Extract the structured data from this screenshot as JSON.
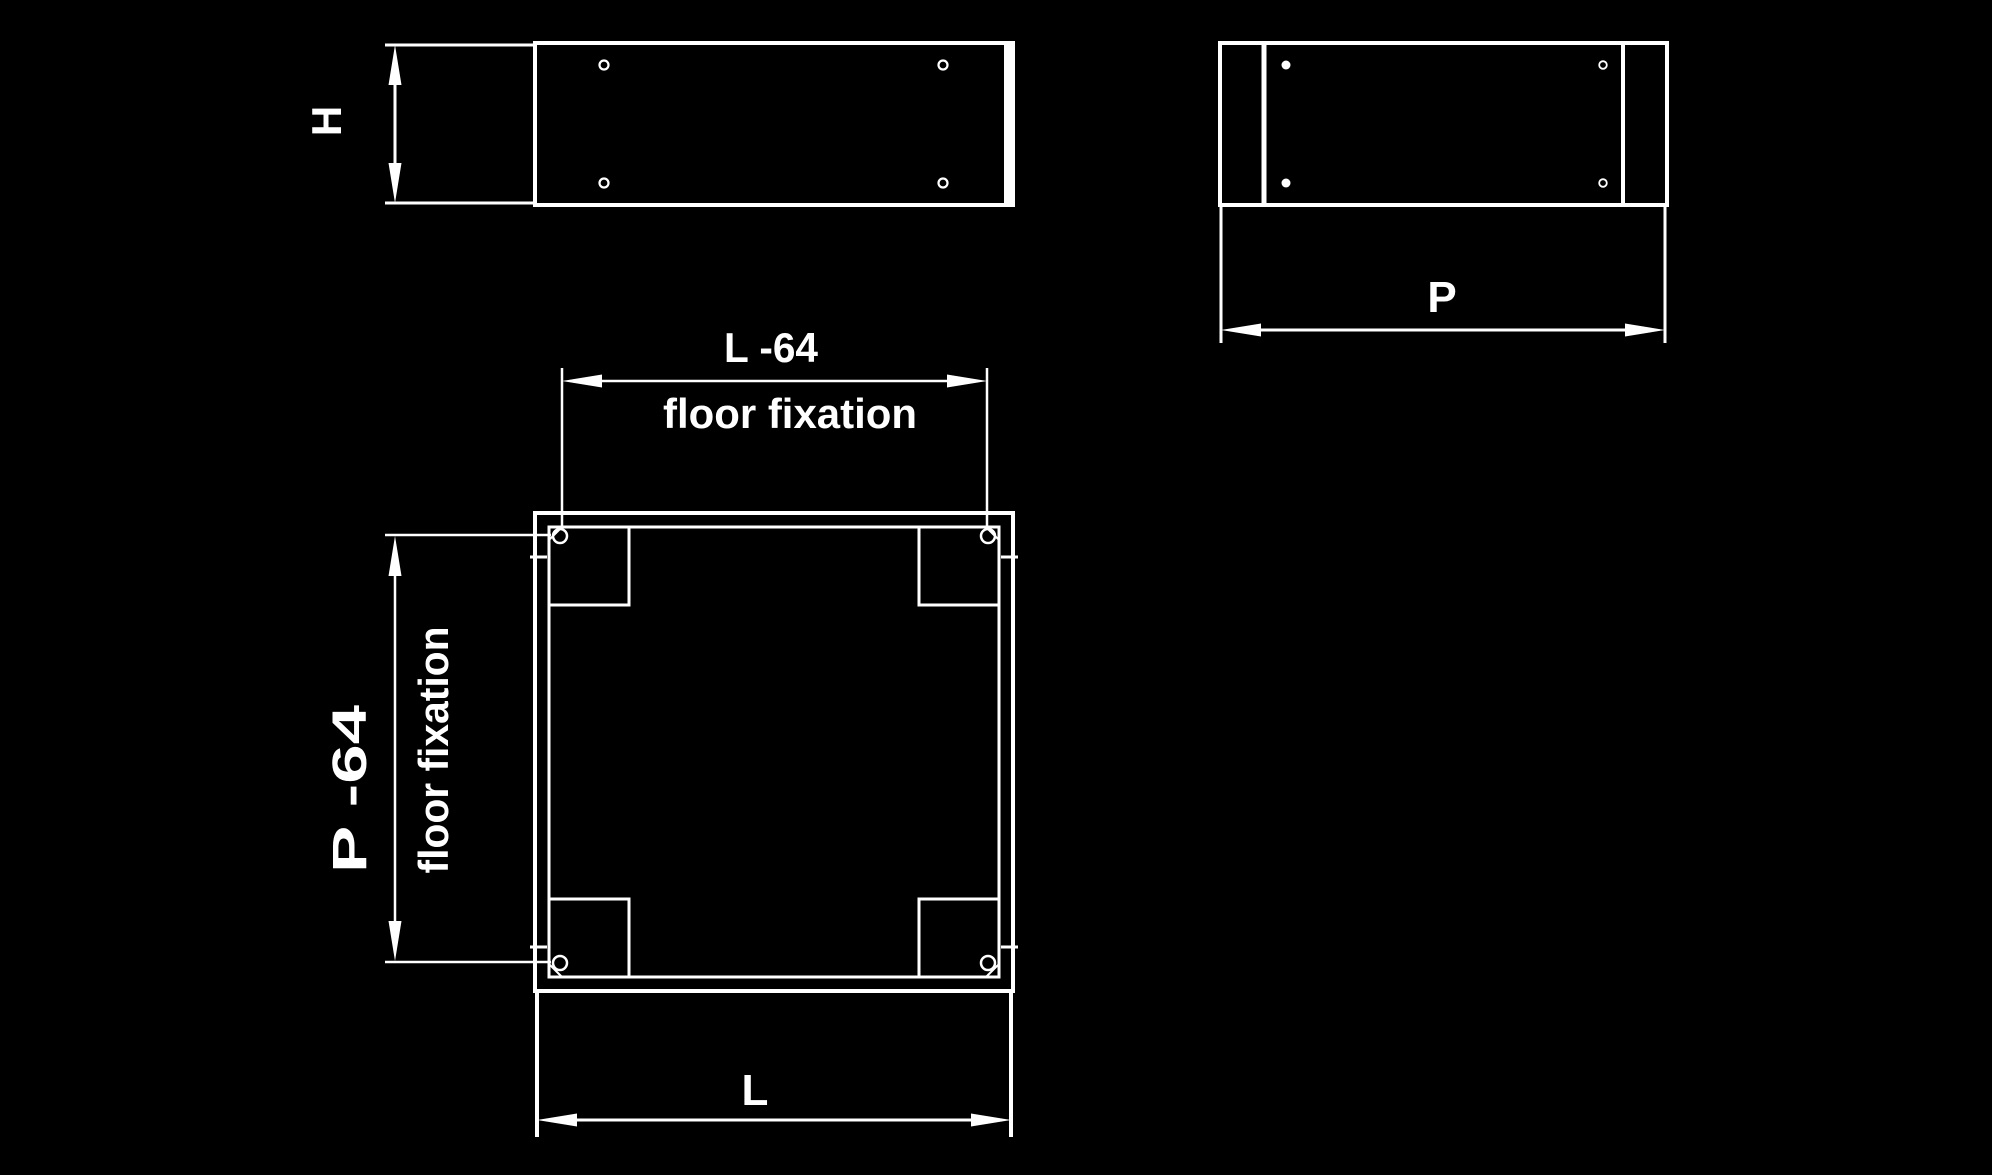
{
  "canvas": {
    "background_color": "#000000",
    "line_color": "#ffffff"
  },
  "drawing": {
    "type": "technical-drawing",
    "subject": "plinth / base floor fixation",
    "views": {
      "front_view": {
        "holes": 4,
        "dimension": "H"
      },
      "side_view": {
        "holes": 4,
        "dimension": "P"
      },
      "top_view": {
        "corner_gussets": 4,
        "fixation_holes": 4
      }
    }
  },
  "dimensions": {
    "height": {
      "label": "H"
    },
    "depth": {
      "label": "P"
    },
    "width": {
      "label": "L"
    },
    "hole_spacing_width": {
      "label": "L -64",
      "note": "floor fixation"
    },
    "hole_spacing_depth": {
      "label": "P -64",
      "note": "floor fixation"
    }
  }
}
